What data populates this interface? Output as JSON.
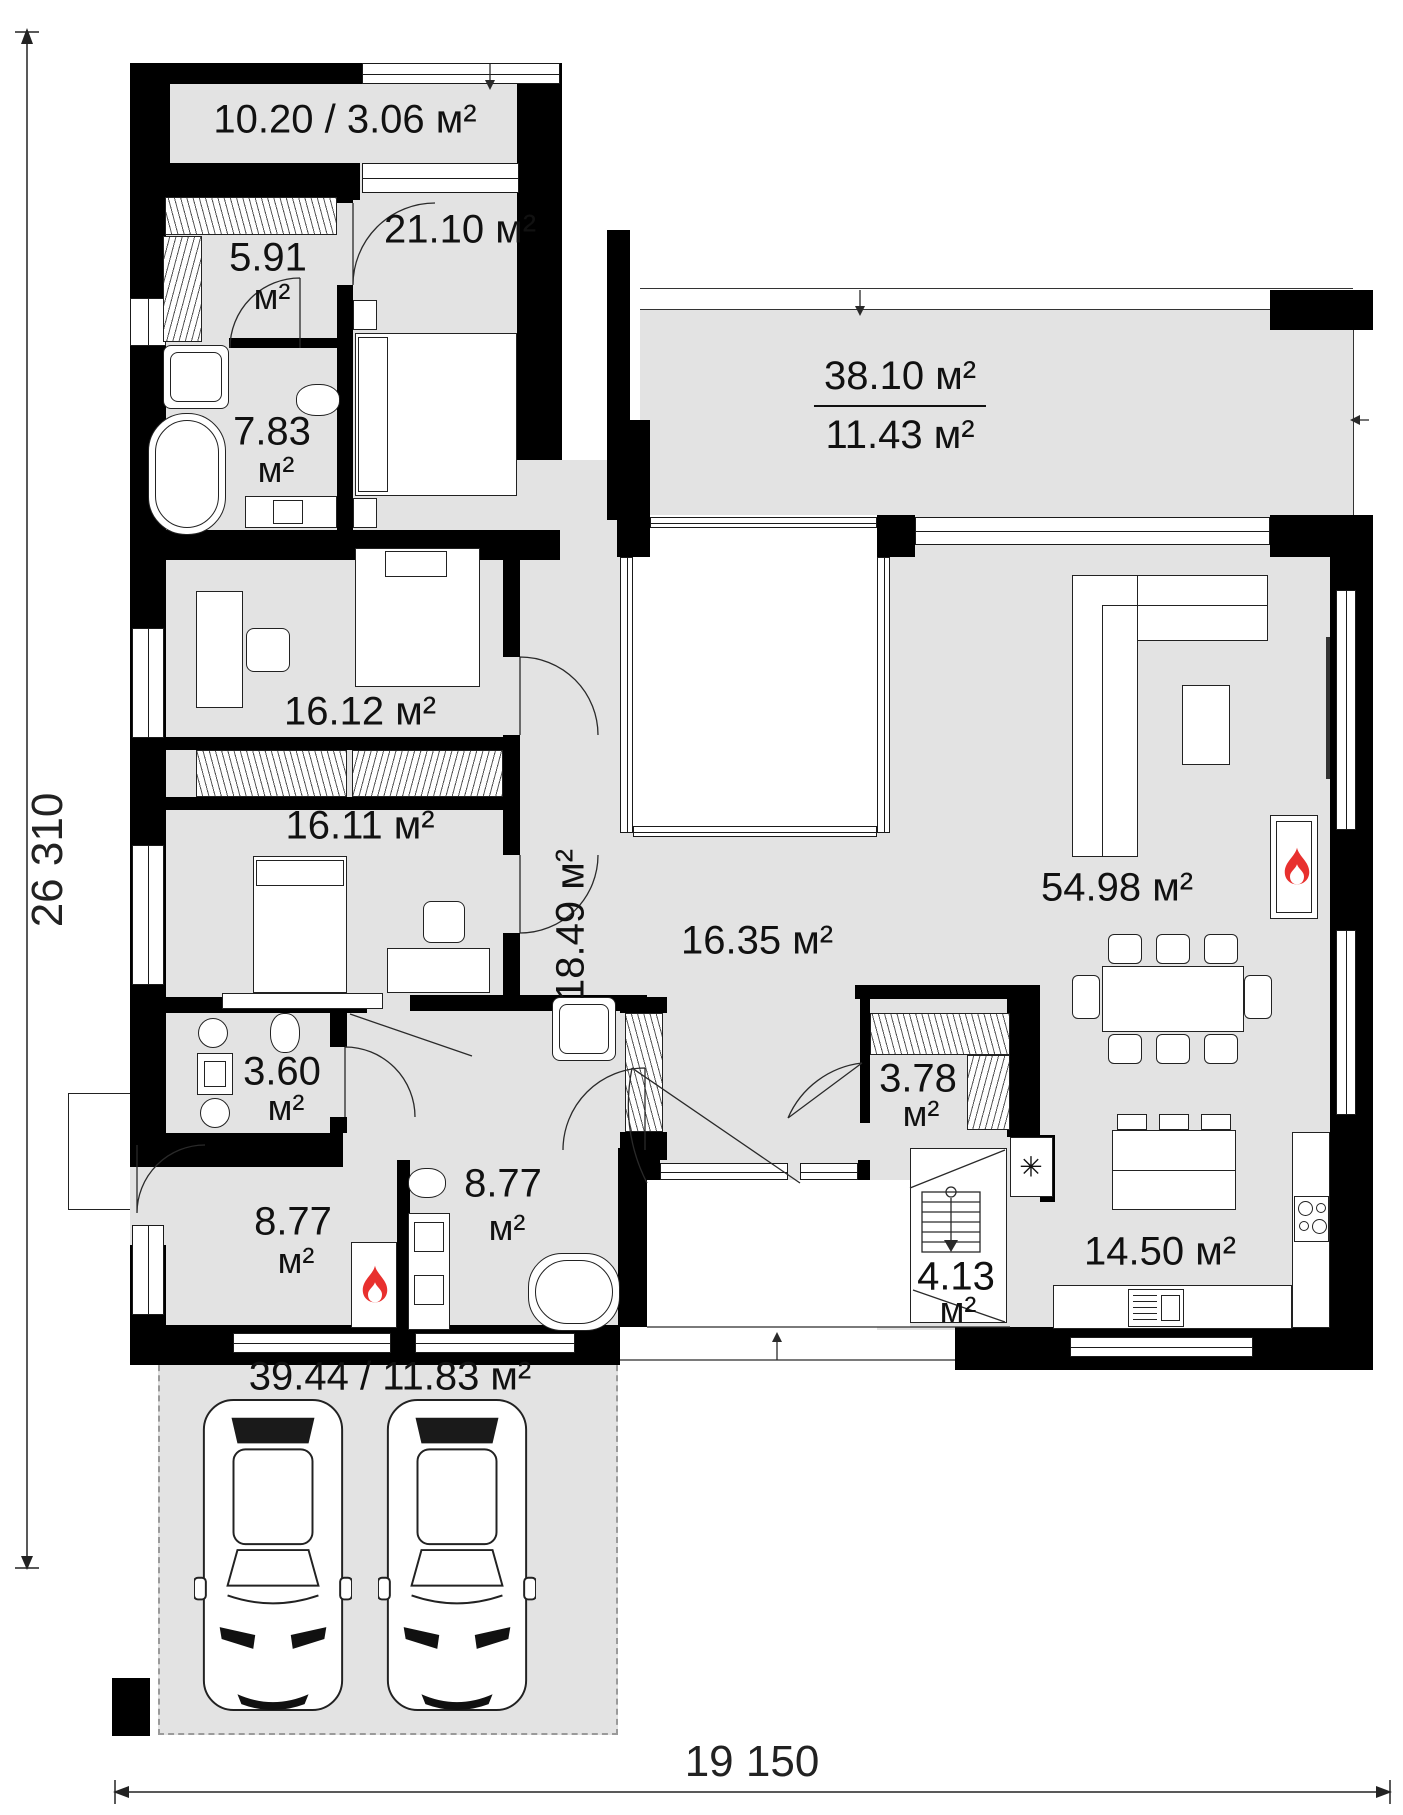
{
  "dimensions": {
    "left": "26 310",
    "bottom": "19 150"
  },
  "rooms": {
    "terrace_top": {
      "label": "10.20 / 3.06 м²"
    },
    "closet_top": {
      "value": "5.91",
      "unit": "м²"
    },
    "bedroom_master": {
      "label": "21.10 м²"
    },
    "bathroom_top": {
      "value": "7.83",
      "unit": "м²"
    },
    "terrace_right": {
      "total": "38.10 м²",
      "covered": "11.43 м²"
    },
    "bedroom_mid": {
      "label": "16.12 м²"
    },
    "bedroom_low": {
      "label": "16.11 м²"
    },
    "hallway": {
      "label": "18.49 м²"
    },
    "hall_center": {
      "label": "16.35 м²"
    },
    "living": {
      "label": "54.98 м²"
    },
    "wc": {
      "value": "3.60",
      "unit": "м²"
    },
    "closet_right": {
      "value": "3.78",
      "unit": "м²"
    },
    "boiler": {
      "value": "8.77",
      "unit": "м²"
    },
    "bathroom_low": {
      "value": "8.77",
      "unit": "м²"
    },
    "pantry": {
      "value": "4.13",
      "unit": "м²"
    },
    "kitchen": {
      "label": "14.50 м²"
    },
    "carport": {
      "label": "39.44 / 11.83 м²"
    }
  },
  "icons": {
    "snowflake": "✳"
  },
  "colors": {
    "room_fill": "#e3e3e3",
    "wall": "#000000",
    "flame": "#e8302e"
  }
}
